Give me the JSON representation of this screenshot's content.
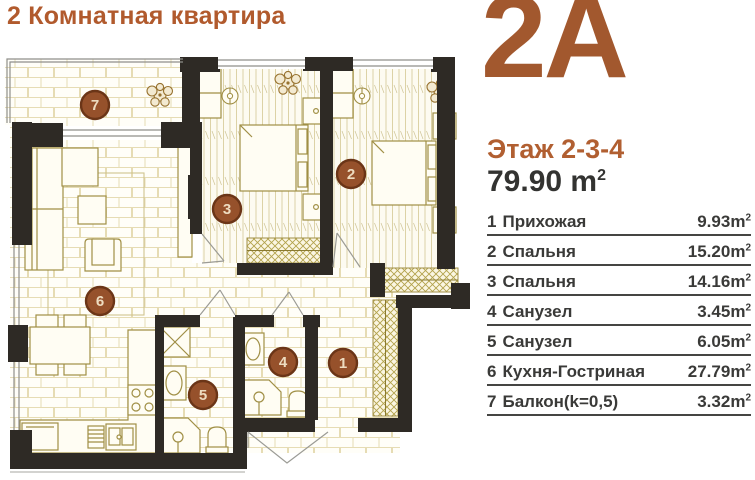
{
  "header": {
    "title": "2 Комнатная квартира"
  },
  "panel": {
    "unit": "2A",
    "floor_label": "Этаж 2-3-4",
    "total_area": "79.90",
    "meter": "m",
    "exp": "2"
  },
  "rooms": [
    {
      "num": "1",
      "name": "Прихожая",
      "area": "9.93"
    },
    {
      "num": "2",
      "name": "Спальня",
      "area": "15.20"
    },
    {
      "num": "3",
      "name": "Спальня",
      "area": "14.16"
    },
    {
      "num": "4",
      "name": "Санузел",
      "area": "3.45"
    },
    {
      "num": "5",
      "name": "Санузел",
      "area": "6.05"
    },
    {
      "num": "6",
      "name": "Кухня-Гостриная",
      "area": "27.79"
    },
    {
      "num": "7",
      "name": "Балкон(k=0,5)",
      "area": "3.32"
    }
  ],
  "colors": {
    "accent_title": "#b15a2d",
    "accent_unit": "#a2582e",
    "text_dark": "#3a3a38",
    "wall": "#2e2a25",
    "floor_line": "#e6dcb4",
    "furniture_line": "#a08f45",
    "marker_fill": "#96512b",
    "marker_ring": "#6b3517",
    "marker_text": "#eedcc0"
  }
}
